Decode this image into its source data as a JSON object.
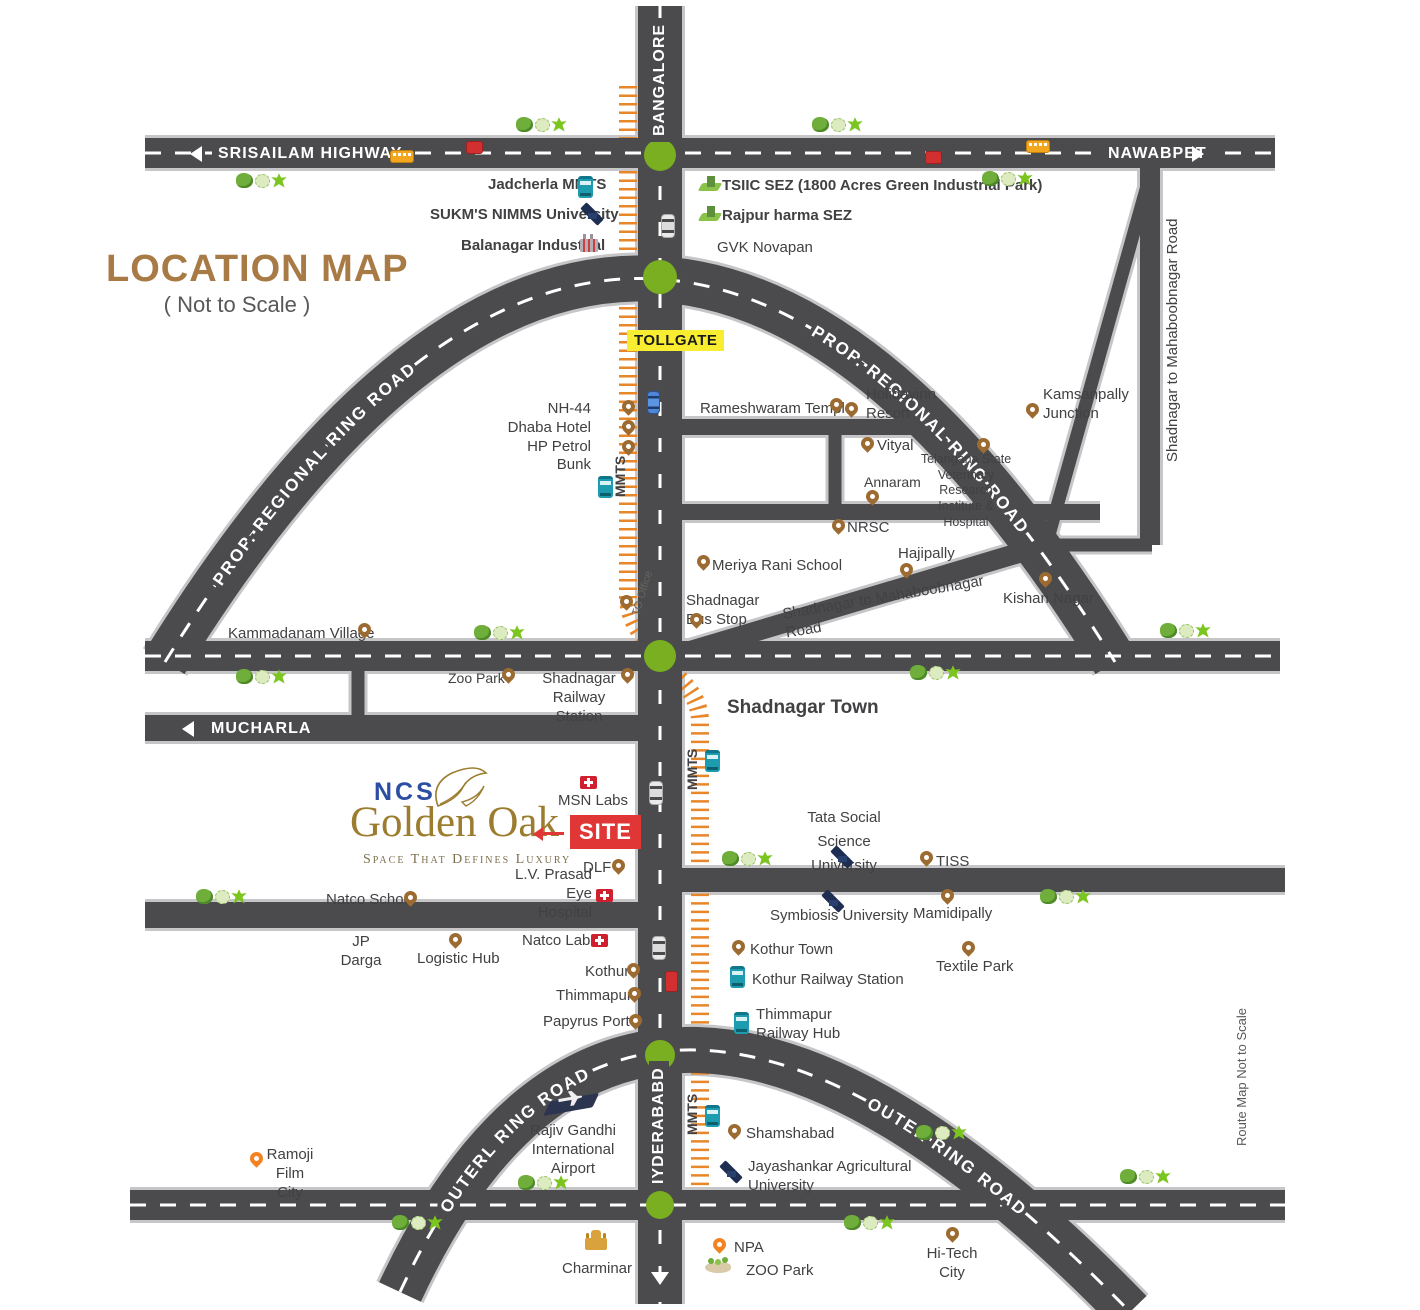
{
  "title": {
    "heading": "LOCATION MAP",
    "subheading": "( Not to Scale )"
  },
  "brand": {
    "name": "NCS",
    "project": "Golden Oak",
    "tagline": "Space That Defines Luxury",
    "site_tag": "SITE"
  },
  "roads": {
    "srisailam": "SRISAILAM HIGHWAY",
    "nawabpet": "NAWABPET",
    "bangalore": "BANGALORE",
    "hyderabad": "IYDERABABD",
    "mucharla": "MUCHARLA",
    "tollgate": "TOLLGATE",
    "prop_regional_ring_road": "PROP. REGIONAL RING ROAD",
    "prop_regional_ring_road_2": "PROP. REGIONAL RING ROAD",
    "outer_ring_road_left": "OUTERL RING ROAD",
    "outer_ring_road_right": "OUTER RING ROAD",
    "shad_mahab_vertical": "Shadnagar to Mahaboobnagar Road",
    "shad_mahab_diagonal": "Shadnagar to Mahaboobnagar Road",
    "mmts_1": "MMTS",
    "mmts_2": "MMTS",
    "mmts_3": "MMTS",
    "to_office": "TO Office",
    "route_note": "Route Map Not to Scale"
  },
  "places": {
    "jadcherla": "Jadcherla MMTS",
    "sukms": "SUKM'S NIMMS University",
    "balanagar": "Balanagar Industrial",
    "tsiic": "TSIIC SEZ (1800 Acres Green Industrial Park)",
    "rajpur": "Rajpur harma SEZ",
    "gvk": "GVK Novapan",
    "nh44": "NH-44\nDhaba Hotel\nHP Petrol Bunk",
    "rameshwaram": "Rameshwaram Temple",
    "holidayinn": "Holidayinn\nResort",
    "kamsanpally": "Kamsanpally\nJunction",
    "vityal": "Vityal",
    "telangana": "Telangana State\nVeterinary Research\nInstitute & Hospital",
    "annaram": "Annaram",
    "nrsc": "NRSC",
    "meriya": "Meriya Rani School",
    "hajipally": "Hajipally",
    "kishan": "Kishan Nagar",
    "shadnagar_bus": "Shadnagar\nBus Stop",
    "kammadanam": "Kammadanam Village",
    "zoo_park": "Zoo Park",
    "shadnagar_rail": "Shadnagar\nRailway Station",
    "shadnagar_town": "Shadnagar Town",
    "msn_labs": "MSN Labs",
    "dlf": "DLF",
    "lv_prasad": "L.V. Prasad\nEye Hospital",
    "natco_school": "Natco School",
    "jp_darga": "JP\nDarga",
    "logistic_hub": "Logistic Hub",
    "natco_labs": "Natco Labs",
    "kothur": "Kothur",
    "thimmapur": "Thimmapur",
    "papyrus_port": "Papyrus Port",
    "tata_social": "Tata Social\nScience University",
    "tiss": "TISS",
    "symbiosis": "Symbiosis University",
    "mamidipally": "Mamidipally",
    "kothur_town": "Kothur Town",
    "kothur_rail": "Kothur Railway Station",
    "textile_park": "Textile Park",
    "thimmapur_hub": "Thimmapur\nRailway Hub",
    "rajiv_gandhi": "Rajiv Gandhi\nInternational Airport",
    "ramoji": "Ramoji\nFilm City",
    "shamshabad": "Shamshabad",
    "jayashankar": "Jayashankar Agricultural\nUniversity",
    "npa": "NPA",
    "zoo_park_2": "ZOO Park",
    "charminar": "Charminar",
    "hitech": "Hi-Tech\nCity"
  },
  "colors": {
    "road": "#4b4b4d",
    "road_casing": "#c6c6c8",
    "junction_green": "#79af20",
    "railway_orange": "#e8872a",
    "pin_brown": "#9c6b31",
    "pin_orange": "#f58220",
    "site_red": "#e03636",
    "tollgate_yellow": "#f9ed32",
    "brand_gold": "#9c7c2f",
    "brand_blue": "#2b4ea2",
    "heading_brown": "#a87a45"
  }
}
